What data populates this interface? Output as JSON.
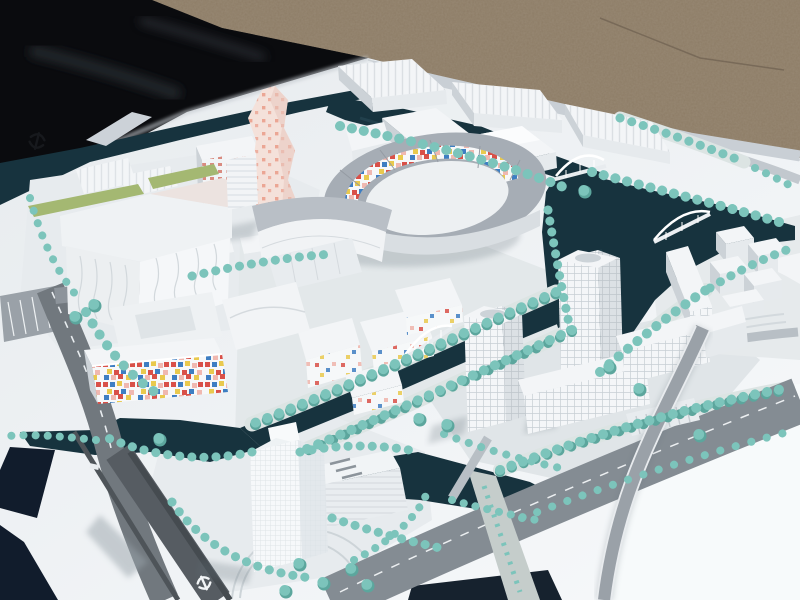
{
  "scene": {
    "kind": "photograph-of-architectural-scale-model",
    "objects": [
      "gravel-ground",
      "black-cloth",
      "white-model-board",
      "apron-canal",
      "apron-bridge",
      "pink-dotted-tower",
      "stadium-ring-mosaic",
      "left-building-complex",
      "top-warehouse-row",
      "mosaic-facade-slab",
      "tile-buildings-cluster",
      "office-tower-pair",
      "office-slabs",
      "island-tower",
      "island-podium",
      "cube-building-cluster",
      "long-bar-building",
      "arch-bridge",
      "bow-bridge",
      "canal-network",
      "boulevard",
      "flyover-ramp",
      "rail-corridor",
      "tram-corridor",
      "parking-lot",
      "tree-rows",
      "transit-logo-marks"
    ]
  },
  "icons": {
    "apron_logo": "rail-transit-logo",
    "road_logo": "rail-transit-logo"
  },
  "palette": {
    "gravel": "#8d7c66",
    "cloth": "#0a0b0e",
    "board": "#eef1f4",
    "water": "#17333e",
    "water_light": "#2a4a57",
    "tree": "#7cc4bb",
    "tree_dark": "#5ca69d",
    "road": "#868e95",
    "road_dark": "#565c62",
    "road_light": "#b5bcc2",
    "roof_gray": "#a6adb5",
    "face": "#e6eaed",
    "side": "#ccd2d7",
    "roofw": "#f3f5f7",
    "grass": "#a4b872",
    "shadow": "#5f6d76",
    "pink": "#f4e1da",
    "pinkdot": "#ea9b89",
    "mosaic_red": "#d95048",
    "mosaic_blue": "#3e7ec2",
    "mosaic_yellow": "#e9c94e",
    "mosaic_pink": "#f0b8b0"
  }
}
